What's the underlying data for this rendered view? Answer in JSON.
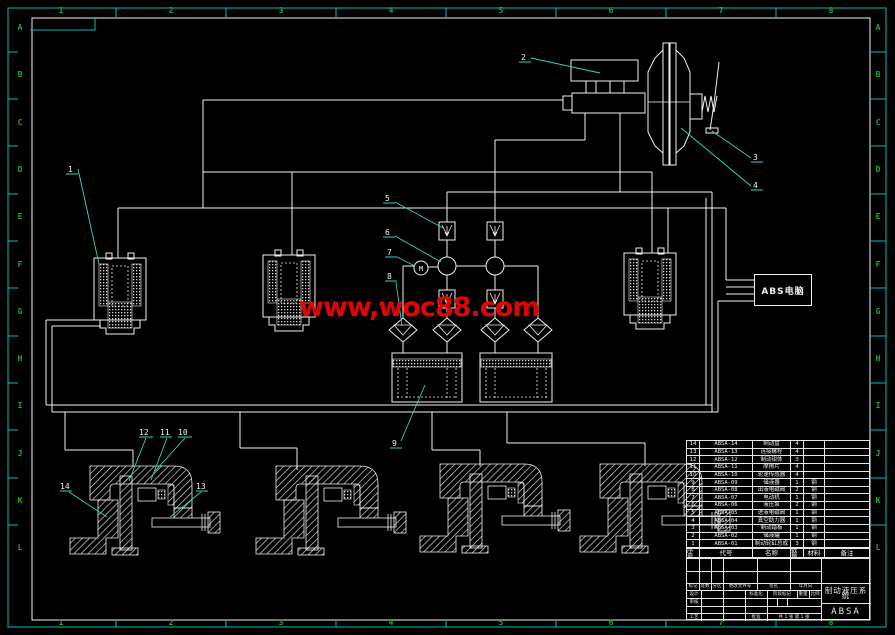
{
  "sheet": {
    "background": "#000000",
    "line_color": "#f0f0f0",
    "frame_color": "#00bcbc",
    "zone_label_color": "#1db01d",
    "leader_color": "#30d6c6",
    "watermark_color": "#e00404"
  },
  "border": {
    "columns": [
      "1",
      "2",
      "3",
      "4",
      "5",
      "6",
      "7",
      "8"
    ],
    "rows": [
      "A",
      "B",
      "C",
      "D",
      "E",
      "F",
      "G",
      "H",
      "I",
      "J",
      "K",
      "L"
    ]
  },
  "watermark": {
    "text": "www,woc88.com"
  },
  "abs_box": {
    "label": "ABS电脑"
  },
  "motor": {
    "label": "M"
  },
  "callouts": {
    "c1": "1",
    "c2": "2",
    "c3": "3",
    "c4": "4",
    "c5": "5",
    "c6": "6",
    "c7": "7",
    "c8": "8",
    "c9": "9",
    "c10": "10",
    "c11": "11",
    "c12": "12",
    "c13": "13",
    "c14": "14"
  },
  "parts_table": {
    "headers": {
      "seq": "序号",
      "code": "代号",
      "name": "名称",
      "qty": "数量",
      "material": "材料",
      "remark": "备注"
    },
    "rows": [
      {
        "seq": "14",
        "code": "ABSA-14",
        "name": "制动盘",
        "qty": "4",
        "material": "",
        "remark": ""
      },
      {
        "seq": "13",
        "code": "ABSA-13",
        "name": "连接螺栓",
        "qty": "4",
        "material": "",
        "remark": ""
      },
      {
        "seq": "12",
        "code": "ABSA-12",
        "name": "制动钳体",
        "qty": "3",
        "material": "",
        "remark": ""
      },
      {
        "seq": "11",
        "code": "ABSA-11",
        "name": "摩擦片",
        "qty": "4",
        "material": "",
        "remark": ""
      },
      {
        "seq": "10",
        "code": "ABSA-10",
        "name": "轮速传感器",
        "qty": "4",
        "material": "",
        "remark": ""
      },
      {
        "seq": "9",
        "code": "ABSA-09",
        "name": "储液器",
        "qty": "1",
        "material": "钢",
        "remark": ""
      },
      {
        "seq": "8",
        "code": "ABSA-08",
        "name": "出液电磁阀",
        "qty": "2",
        "material": "钢",
        "remark": ""
      },
      {
        "seq": "7",
        "code": "ABSA-07",
        "name": "电动机",
        "qty": "1",
        "material": "钢",
        "remark": ""
      },
      {
        "seq": "6",
        "code": "ABSA-06",
        "name": "液压泵",
        "qty": "2",
        "material": "钢",
        "remark": ""
      },
      {
        "seq": "5",
        "code": "ABSA-05",
        "name": "进液电磁阀",
        "qty": "1",
        "material": "钢",
        "remark": ""
      },
      {
        "seq": "4",
        "code": "ABSA-04",
        "name": "真空助力器",
        "qty": "1",
        "material": "钢",
        "remark": ""
      },
      {
        "seq": "3",
        "code": "ABSA-03",
        "name": "制动踏板",
        "qty": "1",
        "material": "钢",
        "remark": ""
      },
      {
        "seq": "2",
        "code": "ABSA-02",
        "name": "储液罐",
        "qty": "1",
        "material": "钢",
        "remark": ""
      },
      {
        "seq": "1",
        "code": "ABSA-01",
        "name": "制动轮缸总成",
        "qty": "3",
        "material": "钢",
        "remark": ""
      }
    ]
  },
  "title_block": {
    "revision_headers": [
      "标记",
      "处数",
      "分区",
      "更改文件号",
      "签名",
      "年月日"
    ],
    "design_label": "设计",
    "review_label": "审核",
    "process_label": "工艺",
    "standard_label": "标准化",
    "approve_label": "批准",
    "stage_label": "阶段标记",
    "weight_label": "重量",
    "scale_label": "比例",
    "sheet_info": "共 1 张  第 1 张",
    "title": "制动液压系统",
    "drawing_no": "ABSA"
  }
}
